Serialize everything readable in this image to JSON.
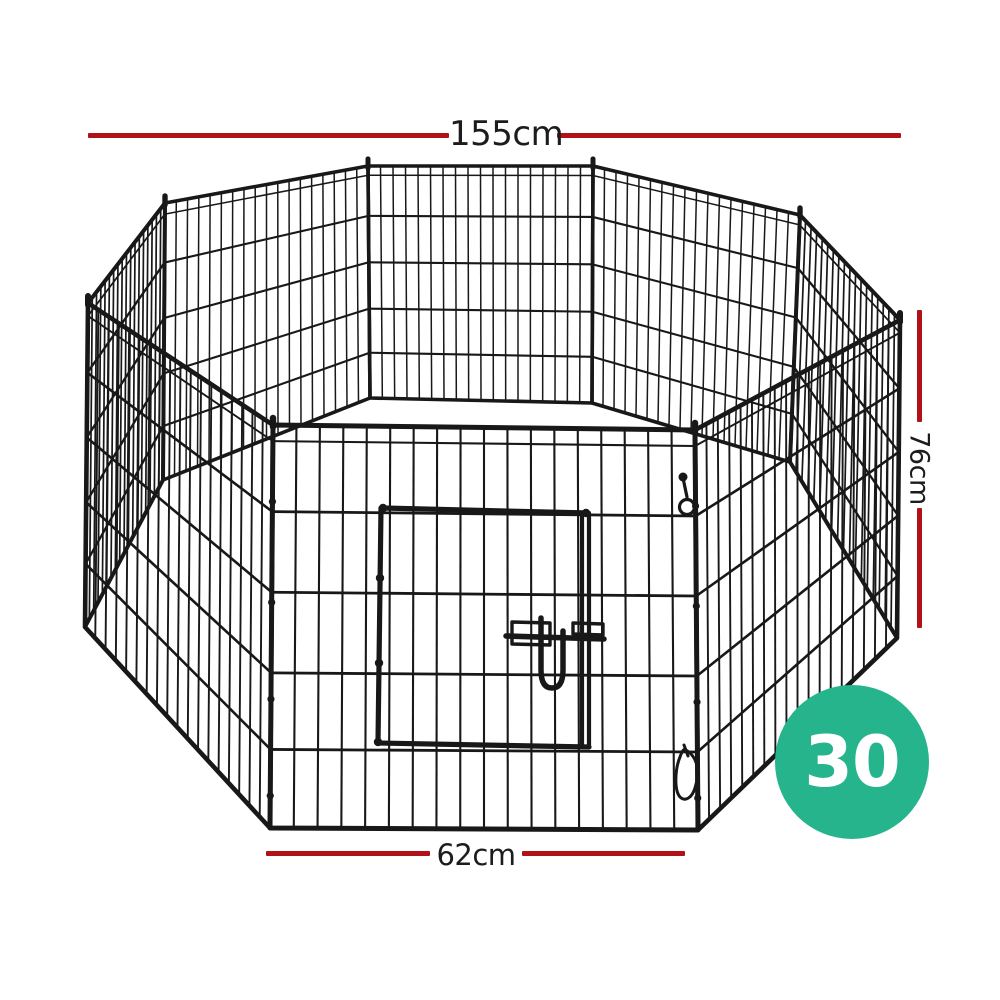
{
  "illustration": {
    "name": "octagonal-8-panel-wire-pet-playpen",
    "parts": [
      "wire-mesh-panels",
      "front-door-with-slide-latch",
      "corner-hinge-posts",
      "snap-hook-clips"
    ]
  },
  "dimensions": {
    "top": "155cm",
    "right": "76cm",
    "bottom": "62cm"
  },
  "badge": {
    "value": "30"
  },
  "colors": {
    "dimension_line": "#b11217",
    "label_text": "#1c1c1c",
    "badge_background": "#26b48c",
    "badge_text": "#ffffff",
    "wire": "#181818",
    "background": "#ffffff"
  }
}
